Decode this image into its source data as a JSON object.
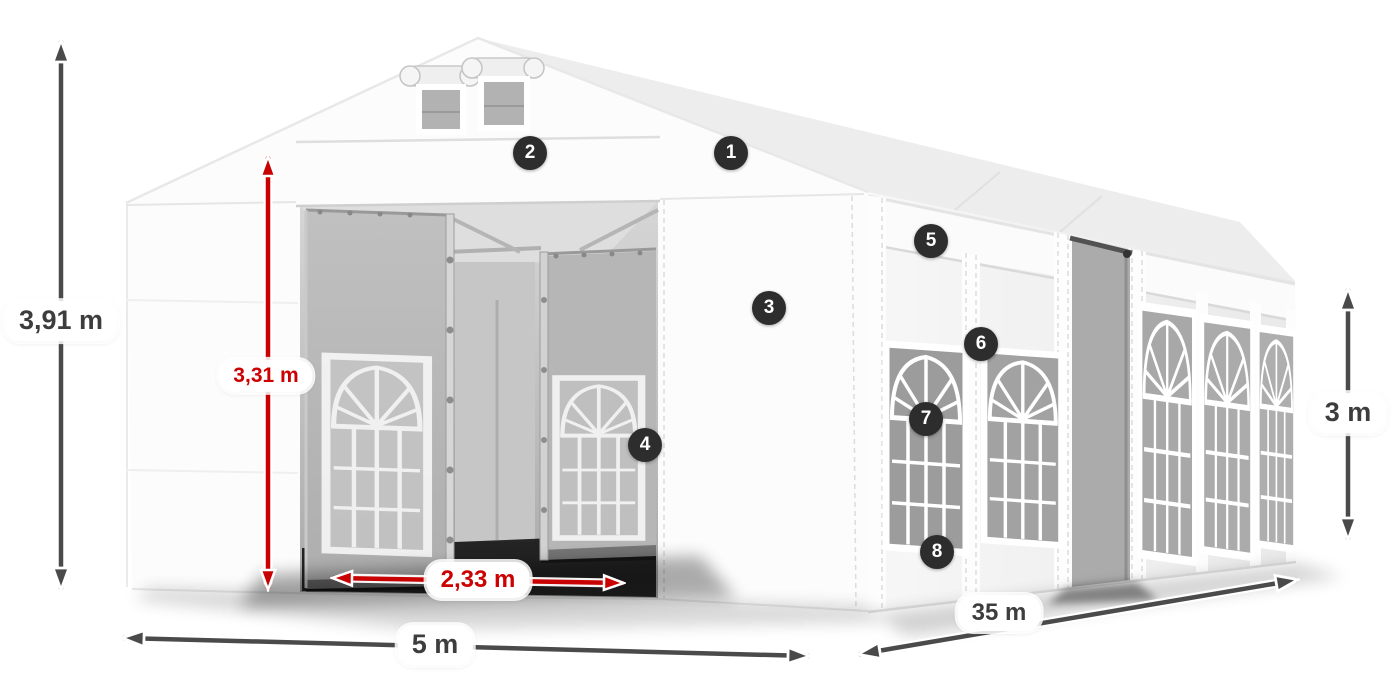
{
  "dimensions": {
    "total_height": {
      "value": "3,91 m",
      "color": "#3d3d3d"
    },
    "entrance_height": {
      "value": "3,31 m",
      "color": "#cc0101"
    },
    "entrance_width": {
      "value": "2,33 m",
      "color": "#cc0101"
    },
    "width": {
      "value": "5 m",
      "color": "#3d3d3d"
    },
    "length": {
      "value": "35 m",
      "color": "#3d3d3d"
    },
    "side_height": {
      "value": "3 m",
      "color": "#3d3d3d"
    }
  },
  "callouts": [
    {
      "number": "1"
    },
    {
      "number": "2"
    },
    {
      "number": "3"
    },
    {
      "number": "4"
    },
    {
      "number": "5"
    },
    {
      "number": "6"
    },
    {
      "number": "7"
    },
    {
      "number": "8"
    }
  ],
  "colors": {
    "dimension_arrow_gray": "#4a4a4a",
    "dimension_arrow_red": "#c80101",
    "callout_badge": "#2d2d2d",
    "tent_fabric": "#fbfbfb",
    "background": "#ffffff"
  }
}
